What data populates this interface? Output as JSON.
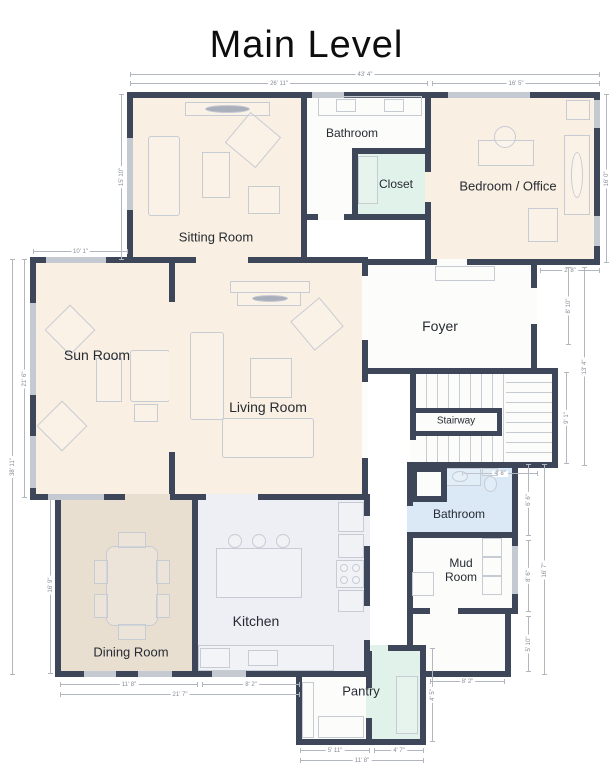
{
  "title": "Main Level",
  "rooms": {
    "sitting": {
      "label": "Sitting Room"
    },
    "bath_top": {
      "label": "Bathroom"
    },
    "closet": {
      "label": "Closet"
    },
    "bedroom_office": {
      "label": "Bedroom / Office"
    },
    "sun": {
      "label": "Sun Room"
    },
    "living": {
      "label": "Living Room"
    },
    "foyer": {
      "label": "Foyer"
    },
    "stairway": {
      "label": "Stairway"
    },
    "bath_bottom": {
      "label": "Bathroom"
    },
    "mud": {
      "label": "Mud Room"
    },
    "dining": {
      "label": "Dining Room"
    },
    "kitchen": {
      "label": "Kitchen"
    },
    "pantry": {
      "label": "Pantry"
    }
  },
  "dimensions": {
    "top_overall": "43' 4\"",
    "top_left": "26' 11\"",
    "top_right": "16' 5\"",
    "left_sitting": "15' 10\"",
    "left_sun_top": "10' 1\"",
    "left_sun": "21' 6\"",
    "left_overall": "38' 11\"",
    "left_dining": "16' 9\"",
    "bottom_dining": "11' 8\"",
    "bottom_kitchen": "8' 2\"",
    "bottom_left_overall": "21' 7\"",
    "bottom_pantry_left": "5' 11\"",
    "bottom_pantry_right": "4' 7\"",
    "bottom_pantry_overall": "11' 8\"",
    "bottom_utility": "8' 2\"",
    "right_bedroom": "16' 0\"",
    "right_notch": "2' 8\"",
    "right_foyer": "8' 10\"",
    "right_mid_overall": "13' 4\"",
    "right_stairs": "9' 1\"",
    "below_stairs": "4' 8\"",
    "right_bath": "6' 6\"",
    "right_mud": "8' 6\"",
    "right_lower_overall": "16' 7\"",
    "right_utility": "5' 10\"",
    "right_pantry": "4' 5\""
  },
  "colors": {
    "wall": "#3e4659",
    "room_beige": "#f9efe2",
    "room_tan": "#e9dfd1",
    "room_kitchen": "#edeff5",
    "room_mint": "#e1f2ea",
    "room_blue": "#dbe9f6",
    "room_white": "#fcfcfa",
    "furniture_line": "#c7cbd4",
    "dimension_line": "#b2b7bf"
  }
}
